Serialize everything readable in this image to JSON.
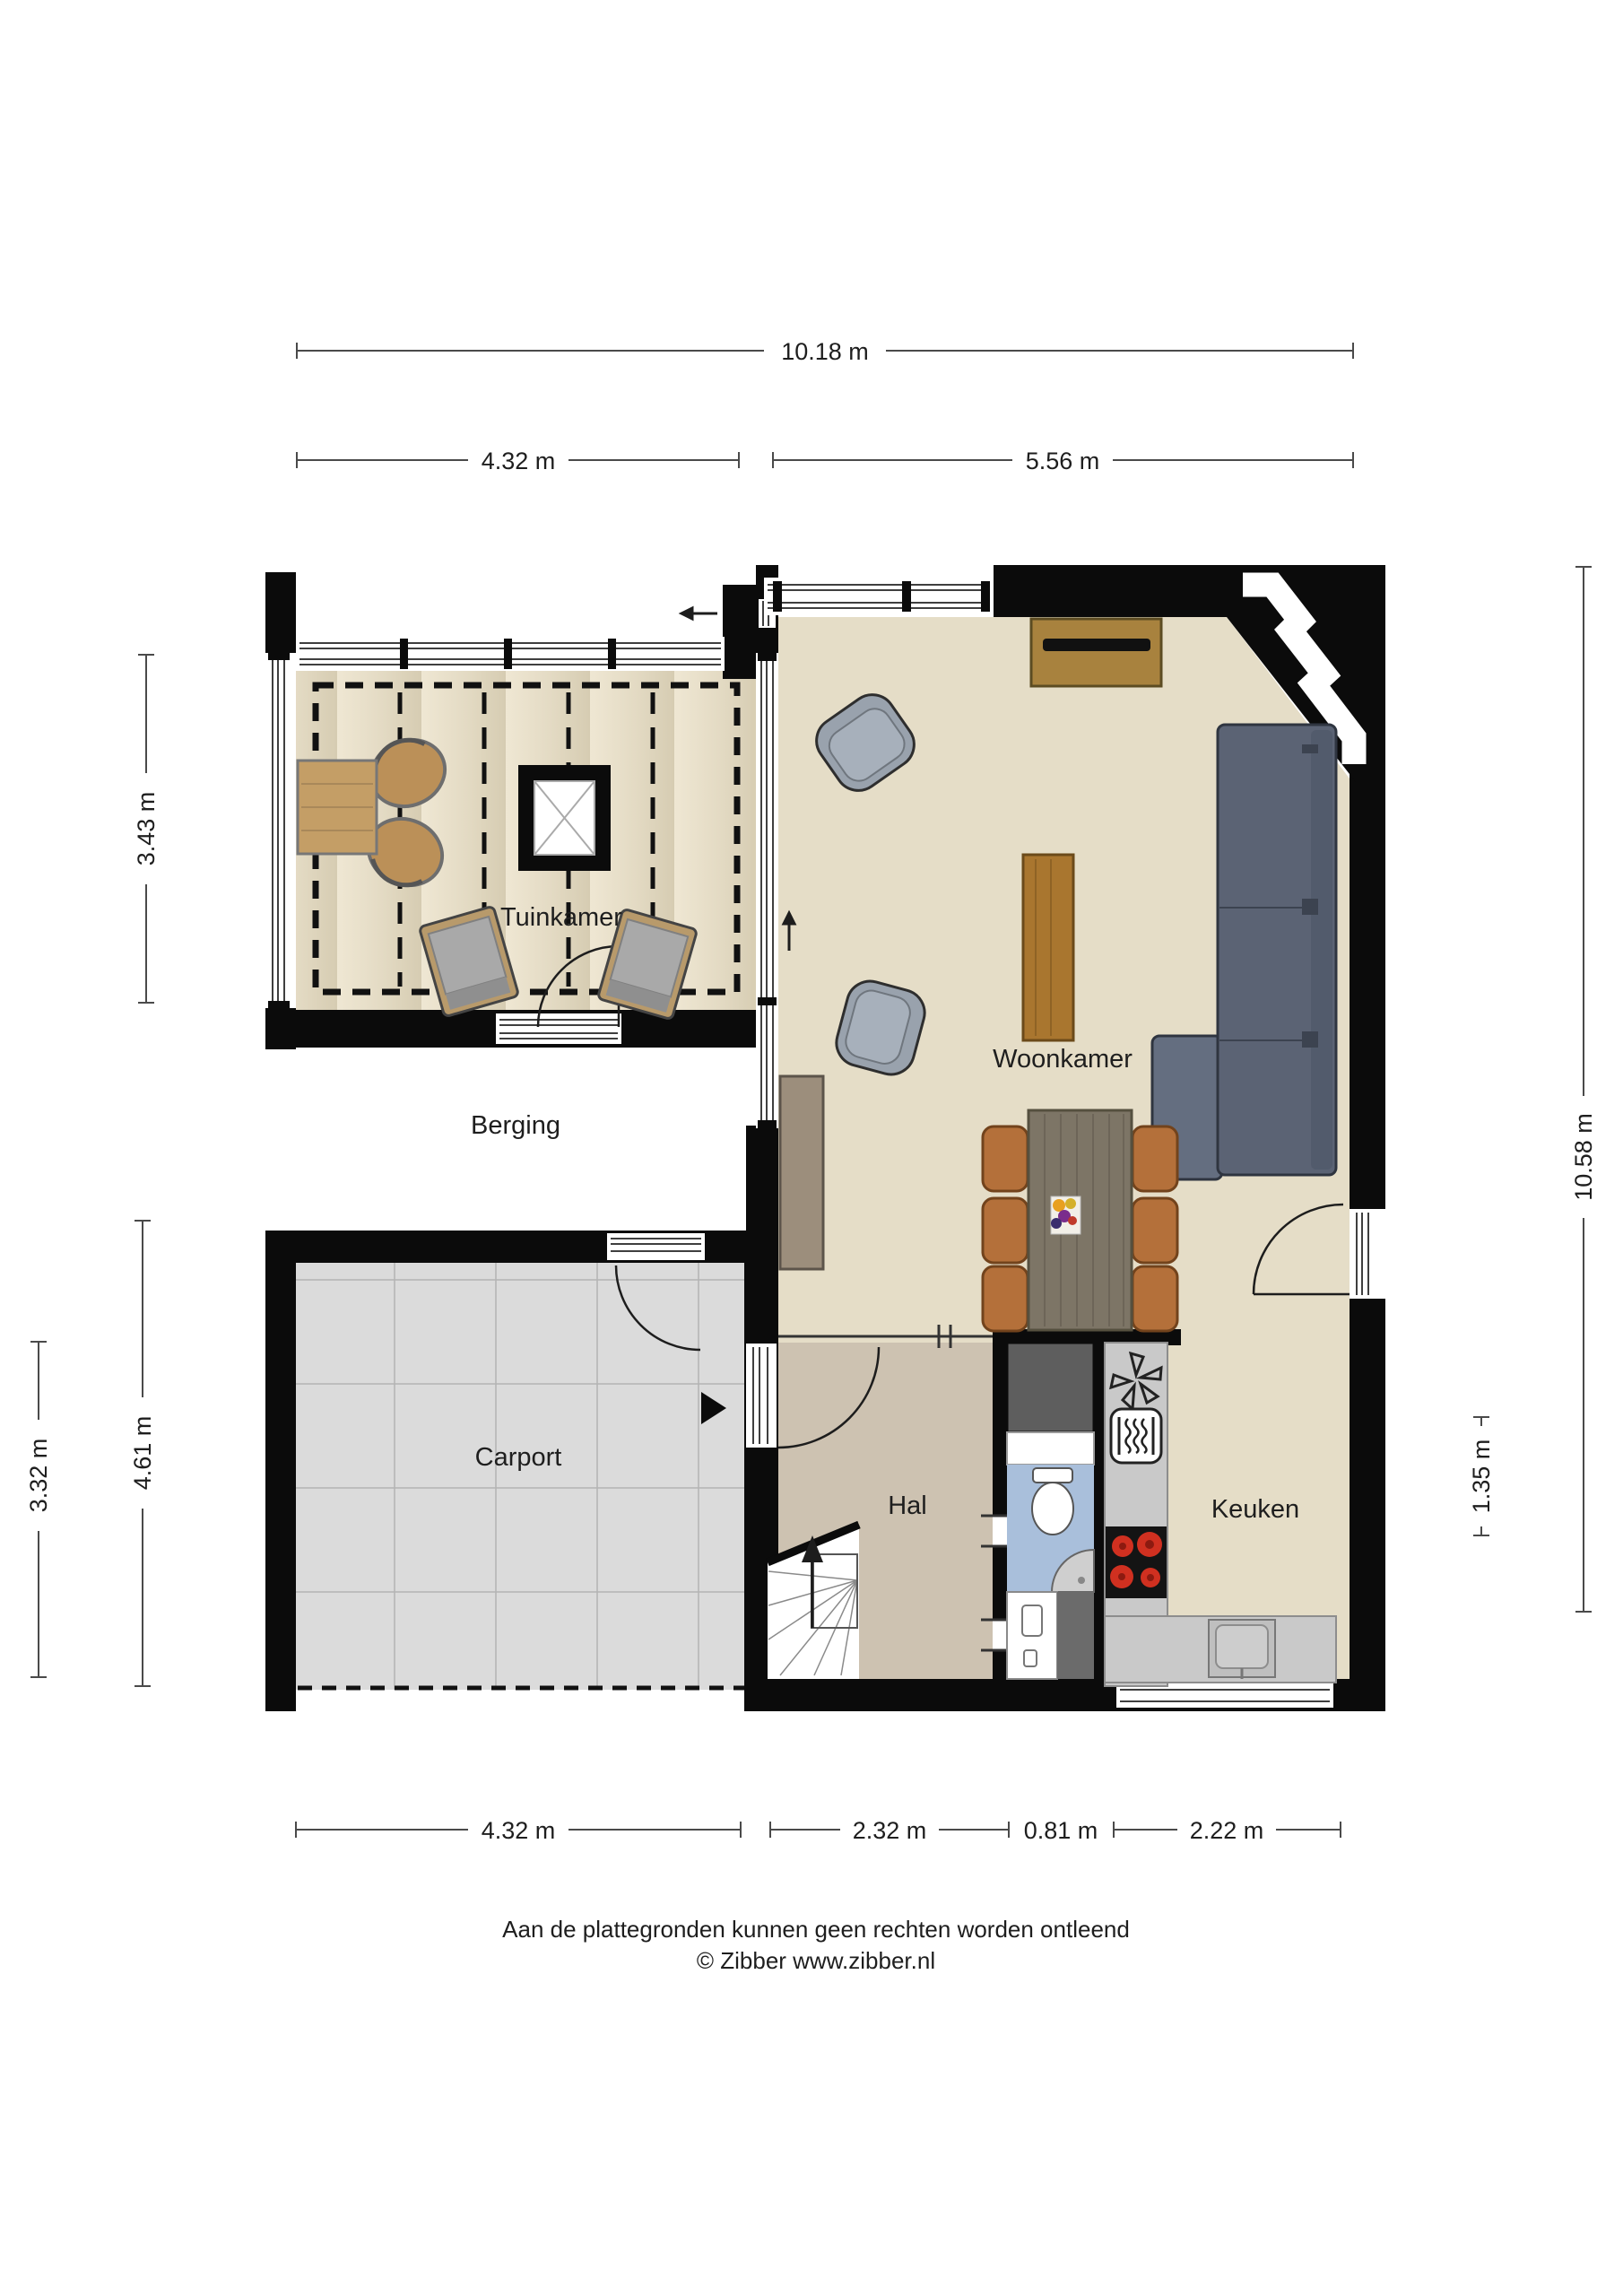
{
  "document": {
    "type": "floor-plan",
    "language": "nl",
    "background": "#ffffff"
  },
  "rooms": {
    "tuinkamer": {
      "label": "Tuinkamer"
    },
    "berging": {
      "label": "Berging"
    },
    "woonkamer": {
      "label": "Woonkamer"
    },
    "carport": {
      "label": "Carport"
    },
    "hal": {
      "label": "Hal"
    },
    "keuken": {
      "label": "Keuken"
    }
  },
  "dimensions": {
    "top_total": {
      "label": "10.18 m",
      "value_m": 10.18,
      "edge": "top"
    },
    "top_left": {
      "label": "4.32 m",
      "value_m": 4.32,
      "edge": "top"
    },
    "top_right": {
      "label": "5.56 m",
      "value_m": 5.56,
      "edge": "top"
    },
    "left_tuinkamer": {
      "label": "3.43 m",
      "value_m": 3.43,
      "edge": "left"
    },
    "left_carport": {
      "label": "4.61 m",
      "value_m": 4.61,
      "edge": "left"
    },
    "left_outer": {
      "label": "3.32 m",
      "value_m": 3.32,
      "edge": "left"
    },
    "right_total": {
      "label": "10.58 m",
      "value_m": 10.58,
      "edge": "right"
    },
    "right_keuken": {
      "label": "1.35 m",
      "value_m": 1.35,
      "edge": "right"
    },
    "bottom_carport": {
      "label": "4.32 m",
      "value_m": 4.32,
      "edge": "bottom"
    },
    "bottom_hal": {
      "label": "2.32 m",
      "value_m": 2.32,
      "edge": "bottom"
    },
    "bottom_toilet": {
      "label": "0.81 m",
      "value_m": 0.81,
      "edge": "bottom"
    },
    "bottom_keuken": {
      "label": "2.22 m",
      "value_m": 2.22,
      "edge": "bottom"
    }
  },
  "footer": {
    "line1": "Aan de plattegronden kunnen geen rechten worden ontleend",
    "line2": "© Zibber www.zibber.nl"
  },
  "icons": [
    "skylight-icon",
    "extractor-fan-icon",
    "oven-icon",
    "cooktop-icon",
    "sink-icon",
    "toilet-icon",
    "corner-sink-icon",
    "stairs-up-arrow-icon",
    "entrance-arrow-icon",
    "door-swing-arc-icon"
  ],
  "colors": {
    "wall": "#0b0b0b",
    "floor_living": "#e5ddc7",
    "floor_hall": "#cdc2b1",
    "floor_toilet": "#a9bfdb",
    "floor_carport": "#dbdbdb",
    "floor_garden_light": "#efe7d3",
    "floor_garden_dark": "#d6ccb2",
    "sofa": "#5b6374",
    "armchair": "#99a2ad",
    "dining_chair": "#b4703a",
    "dining_table": "#7d7566",
    "wood_furniture": "#a8823e",
    "counter": "#c9c9c9",
    "burner_red": "#d03020",
    "closet_dark": "#5e5e5e"
  }
}
